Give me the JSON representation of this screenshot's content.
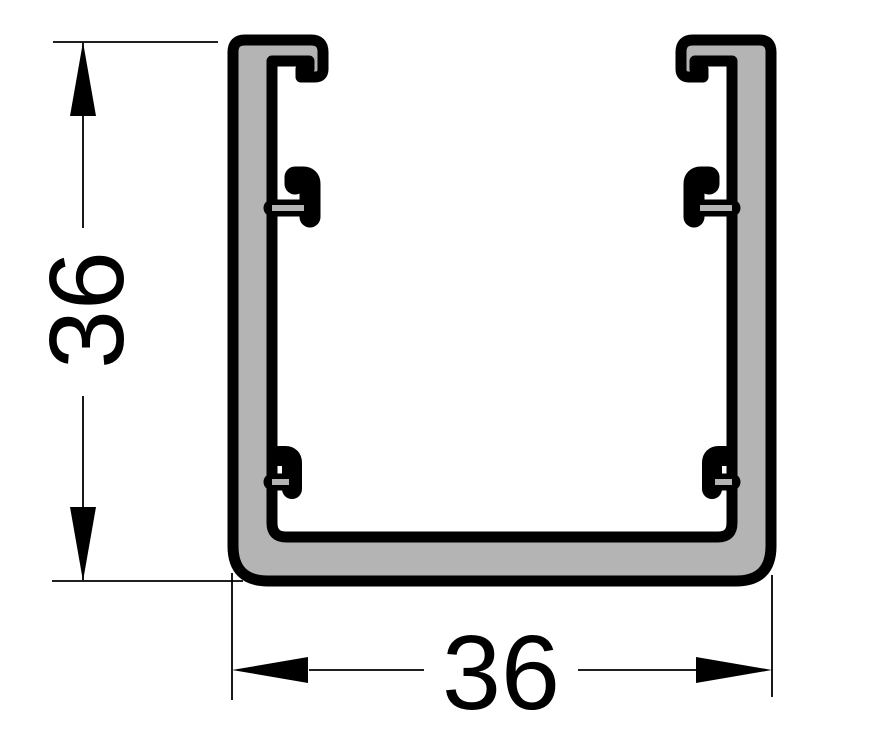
{
  "drawing": {
    "description": "Cross-section of a square U-channel extrusion profile with top cover lips and four internal mounting hooks",
    "dimensions": {
      "height": {
        "value": "36",
        "orientation": "vertical"
      },
      "width": {
        "value": "36",
        "orientation": "horizontal"
      }
    },
    "colors": {
      "profile_fill": "#b4b4b4",
      "outline": "#000000",
      "annotation": "#000000",
      "background": "#ffffff"
    }
  }
}
